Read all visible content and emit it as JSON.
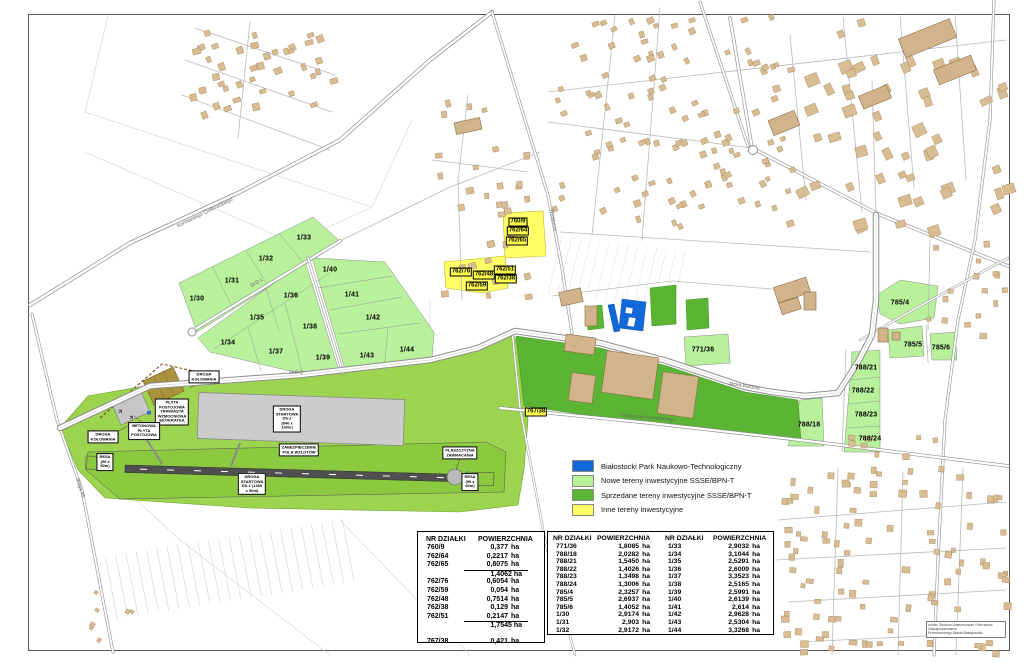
{
  "colors": {
    "bpnt_blue": "#1168d8",
    "new_green": "#b9f09c",
    "sold_green": "#5bb433",
    "other_yellow": "#ffff66"
  },
  "legend": {
    "items": [
      {
        "color": "#1168d8",
        "label": "Białostocki Park Naukowo-Technologiczny"
      },
      {
        "color": "#b9f09c",
        "label": "Nowe tereny inwestycyjne SSSE/BPN-T"
      },
      {
        "color": "#5bb433",
        "label": "Sprzedane tereny inwestycyjne SSSE/BPN-T"
      },
      {
        "color": "#ffff66",
        "label": "Inne tereny inwestycyjne"
      }
    ]
  },
  "map": {
    "parcel_labels": [
      {
        "text": "1/30",
        "x": 197,
        "y": 299
      },
      {
        "text": "1/31",
        "x": 232,
        "y": 281
      },
      {
        "text": "1/32",
        "x": 266,
        "y": 259
      },
      {
        "text": "1/33",
        "x": 304,
        "y": 238
      },
      {
        "text": "1/34",
        "x": 228,
        "y": 343
      },
      {
        "text": "1/35",
        "x": 257,
        "y": 318
      },
      {
        "text": "1/36",
        "x": 291,
        "y": 296
      },
      {
        "text": "1/37",
        "x": 276,
        "y": 352
      },
      {
        "text": "1/38",
        "x": 310,
        "y": 327
      },
      {
        "text": "1/39",
        "x": 323,
        "y": 358
      },
      {
        "text": "1/40",
        "x": 330,
        "y": 270
      },
      {
        "text": "1/41",
        "x": 352,
        "y": 295
      },
      {
        "text": "1/42",
        "x": 373,
        "y": 318
      },
      {
        "text": "1/43",
        "x": 367,
        "y": 356
      },
      {
        "text": "1/44",
        "x": 407,
        "y": 350
      },
      {
        "text": "771/36",
        "x": 703,
        "y": 350
      },
      {
        "text": "785/4",
        "x": 900,
        "y": 303
      },
      {
        "text": "785/5",
        "x": 913,
        "y": 345
      },
      {
        "text": "785/6",
        "x": 941,
        "y": 348
      },
      {
        "text": "788/21",
        "x": 866,
        "y": 368
      },
      {
        "text": "788/22",
        "x": 863,
        "y": 391
      },
      {
        "text": "788/23",
        "x": 866,
        "y": 415
      },
      {
        "text": "788/24",
        "x": 870,
        "y": 439
      },
      {
        "text": "788/18",
        "x": 809,
        "y": 425
      }
    ],
    "yellow_labels": [
      {
        "text": "760/9",
        "x": 518,
        "y": 222
      },
      {
        "text": "762/64",
        "x": 518,
        "y": 231
      },
      {
        "text": "762/65",
        "x": 517,
        "y": 241
      },
      {
        "text": "762/76",
        "x": 461,
        "y": 272
      },
      {
        "text": "762/48",
        "x": 484,
        "y": 275
      },
      {
        "text": "762/51",
        "x": 505,
        "y": 270
      },
      {
        "text": "762/38",
        "x": 506,
        "y": 279
      },
      {
        "text": "762/59",
        "x": 477,
        "y": 286
      },
      {
        "text": "767/38",
        "x": 536,
        "y": 412
      }
    ],
    "info_boxes": [
      {
        "text": "DROGA\nKOŁOWANIA",
        "x": 103,
        "y": 437
      },
      {
        "text": "DROGA\nKOŁOWANIA",
        "x": 204,
        "y": 377
      },
      {
        "text": "PŁYTA\nPOSTOJOWA\nTRAWIASTA\nWZMOCNIONA\nEKOKRATKĄ",
        "x": 172,
        "y": 412
      },
      {
        "text": "BETONOWA\nPŁYTA\nPOSTOJOWA",
        "x": 144,
        "y": 431
      },
      {
        "text": "RESA\n(90 x 60m)",
        "x": 105,
        "y": 462
      },
      {
        "text": "RESA\n(90 x 60m)",
        "x": 470,
        "y": 482
      },
      {
        "text": "DROGA STARTOWA DS-2\n(840 x 160m)",
        "x": 287,
        "y": 419
      },
      {
        "text": "ZABEZPIECZENIE POLA WZLOTÓW",
        "x": 299,
        "y": 450
      },
      {
        "text": "DROGA STARTOWA DS-1 (1300 x 50m)",
        "x": 252,
        "y": 484
      },
      {
        "text": "PŁASZCZYZNA\nZAWRACANIA",
        "x": 460,
        "y": 453
      }
    ],
    "road_labels": [
      {
        "text": "Konstantego Ciołkowskiego",
        "x": 205,
        "y": 213,
        "rot": -26
      },
      {
        "text": "Jacka Kuronia",
        "x": 744,
        "y": 386,
        "rot": 9
      },
      {
        "text": "Franciszka Karpińskiego",
        "x": 648,
        "y": 418,
        "rot": 5
      },
      {
        "text": "Wiosenna",
        "x": 553,
        "y": 220,
        "rot": 80
      },
      {
        "text": "3KD-L",
        "x": 257,
        "y": 283,
        "rot": -31
      },
      {
        "text": "1KD-Z",
        "x": 296,
        "y": 373,
        "rot": 2
      },
      {
        "text": "droga 65",
        "x": 80,
        "y": 488,
        "rot": 72
      }
    ]
  },
  "tables": {
    "table1": {
      "headers": [
        "NR DZIAŁKI",
        "POWIERZCHNIA"
      ],
      "unit": "ha",
      "groups": [
        {
          "rows": [
            [
              "760/9",
              "0,377"
            ],
            [
              "762/64",
              "0,2217"
            ],
            [
              "762/65",
              "0,8075"
            ]
          ],
          "subtotal": "1,4062"
        },
        {
          "rows": [
            [
              "762/76",
              "0,6054"
            ],
            [
              "762/59",
              "0,054"
            ],
            [
              "762/48",
              "0,7514"
            ],
            [
              "762/38",
              "0,129"
            ],
            [
              "762/51",
              "0,2147"
            ]
          ],
          "subtotal": "1,7545"
        }
      ],
      "extra_row": [
        "767/38",
        "0,421"
      ]
    },
    "table2": {
      "headers": [
        "NR DZIAŁKI",
        "POWIERZCHNIA",
        "NR DZIAŁKI",
        "POWIERZCHNIA"
      ],
      "unit": "ha",
      "rows": [
        [
          "771/36",
          "1,8085",
          "1/33",
          "2,9032"
        ],
        [
          "788/18",
          "2,0282",
          "1/34",
          "3,1044"
        ],
        [
          "788/21",
          "1,5450",
          "1/35",
          "2,5291"
        ],
        [
          "788/22",
          "1,4026",
          "1/36",
          "2,6009"
        ],
        [
          "788/23",
          "1,3498",
          "1/37",
          "3,3523"
        ],
        [
          "788/24",
          "1,3006",
          "1/38",
          "2,5165"
        ],
        [
          "785/4",
          "2,3257",
          "1/39",
          "2,5991"
        ],
        [
          "785/5",
          "2,6937",
          "1/40",
          "2,6139"
        ],
        [
          "785/6",
          "1,4052",
          "1/41",
          "2,614"
        ],
        [
          "1/30",
          "2,9174",
          "1/42",
          "2,9628"
        ],
        [
          "1/31",
          "2,903",
          "1/43",
          "2,5304"
        ],
        [
          "1/32",
          "2,9172",
          "1/44",
          "3,3268"
        ]
      ]
    }
  },
  "attribution": {
    "lines": [
      "źródło: Studium Uwarunkowań i Kierunków Zagospodarowania",
      "Przestrzennego Miasta Białegostoku"
    ]
  }
}
